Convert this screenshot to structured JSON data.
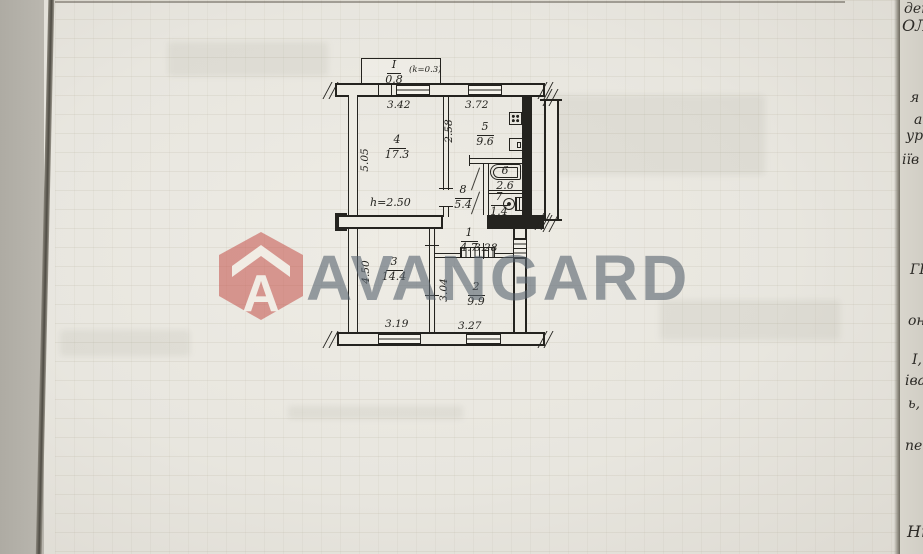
{
  "watermark": {
    "brand": "AVANGARD",
    "monogram": "A"
  },
  "floorplan": {
    "balcony": {
      "number": "I",
      "area": "0.8",
      "coef_note": "(k=0.3)"
    },
    "rooms": [
      {
        "n": "4",
        "area": "17.3"
      },
      {
        "n": "5",
        "area": "9.6"
      },
      {
        "n": "6",
        "area": "2.6"
      },
      {
        "n": "7",
        "area": "1.4"
      },
      {
        "n": "8",
        "area": "5.4"
      },
      {
        "n": "1",
        "area": "4.7"
      },
      {
        "n": "2",
        "area": "9.9"
      },
      {
        "n": "3",
        "area": "14.4"
      }
    ],
    "dims": {
      "top_left": "3.42",
      "top_right": "3.72",
      "left_upper": "5.05",
      "kitchen_left": "2.58",
      "height_note": "h=2.50",
      "hall": "3.28",
      "left_lower": "4.50",
      "room2_left": "3.04",
      "bottom_left": "3.19",
      "bottom_right": "3.27"
    }
  },
  "page_edge_text": {
    "fragments": [
      "дек",
      "ОЛ",
      "я",
      "ас",
      "ур",
      "іїв",
      "ГБ",
      "он.",
      "І,",
      "іва",
      "ь,",
      "пе",
      "Нн"
    ]
  },
  "colors": {
    "logo_red": "#c1463f",
    "logo_gray_blue": "#56636e",
    "paper": "#e8e6df",
    "ink": "#24231f"
  }
}
